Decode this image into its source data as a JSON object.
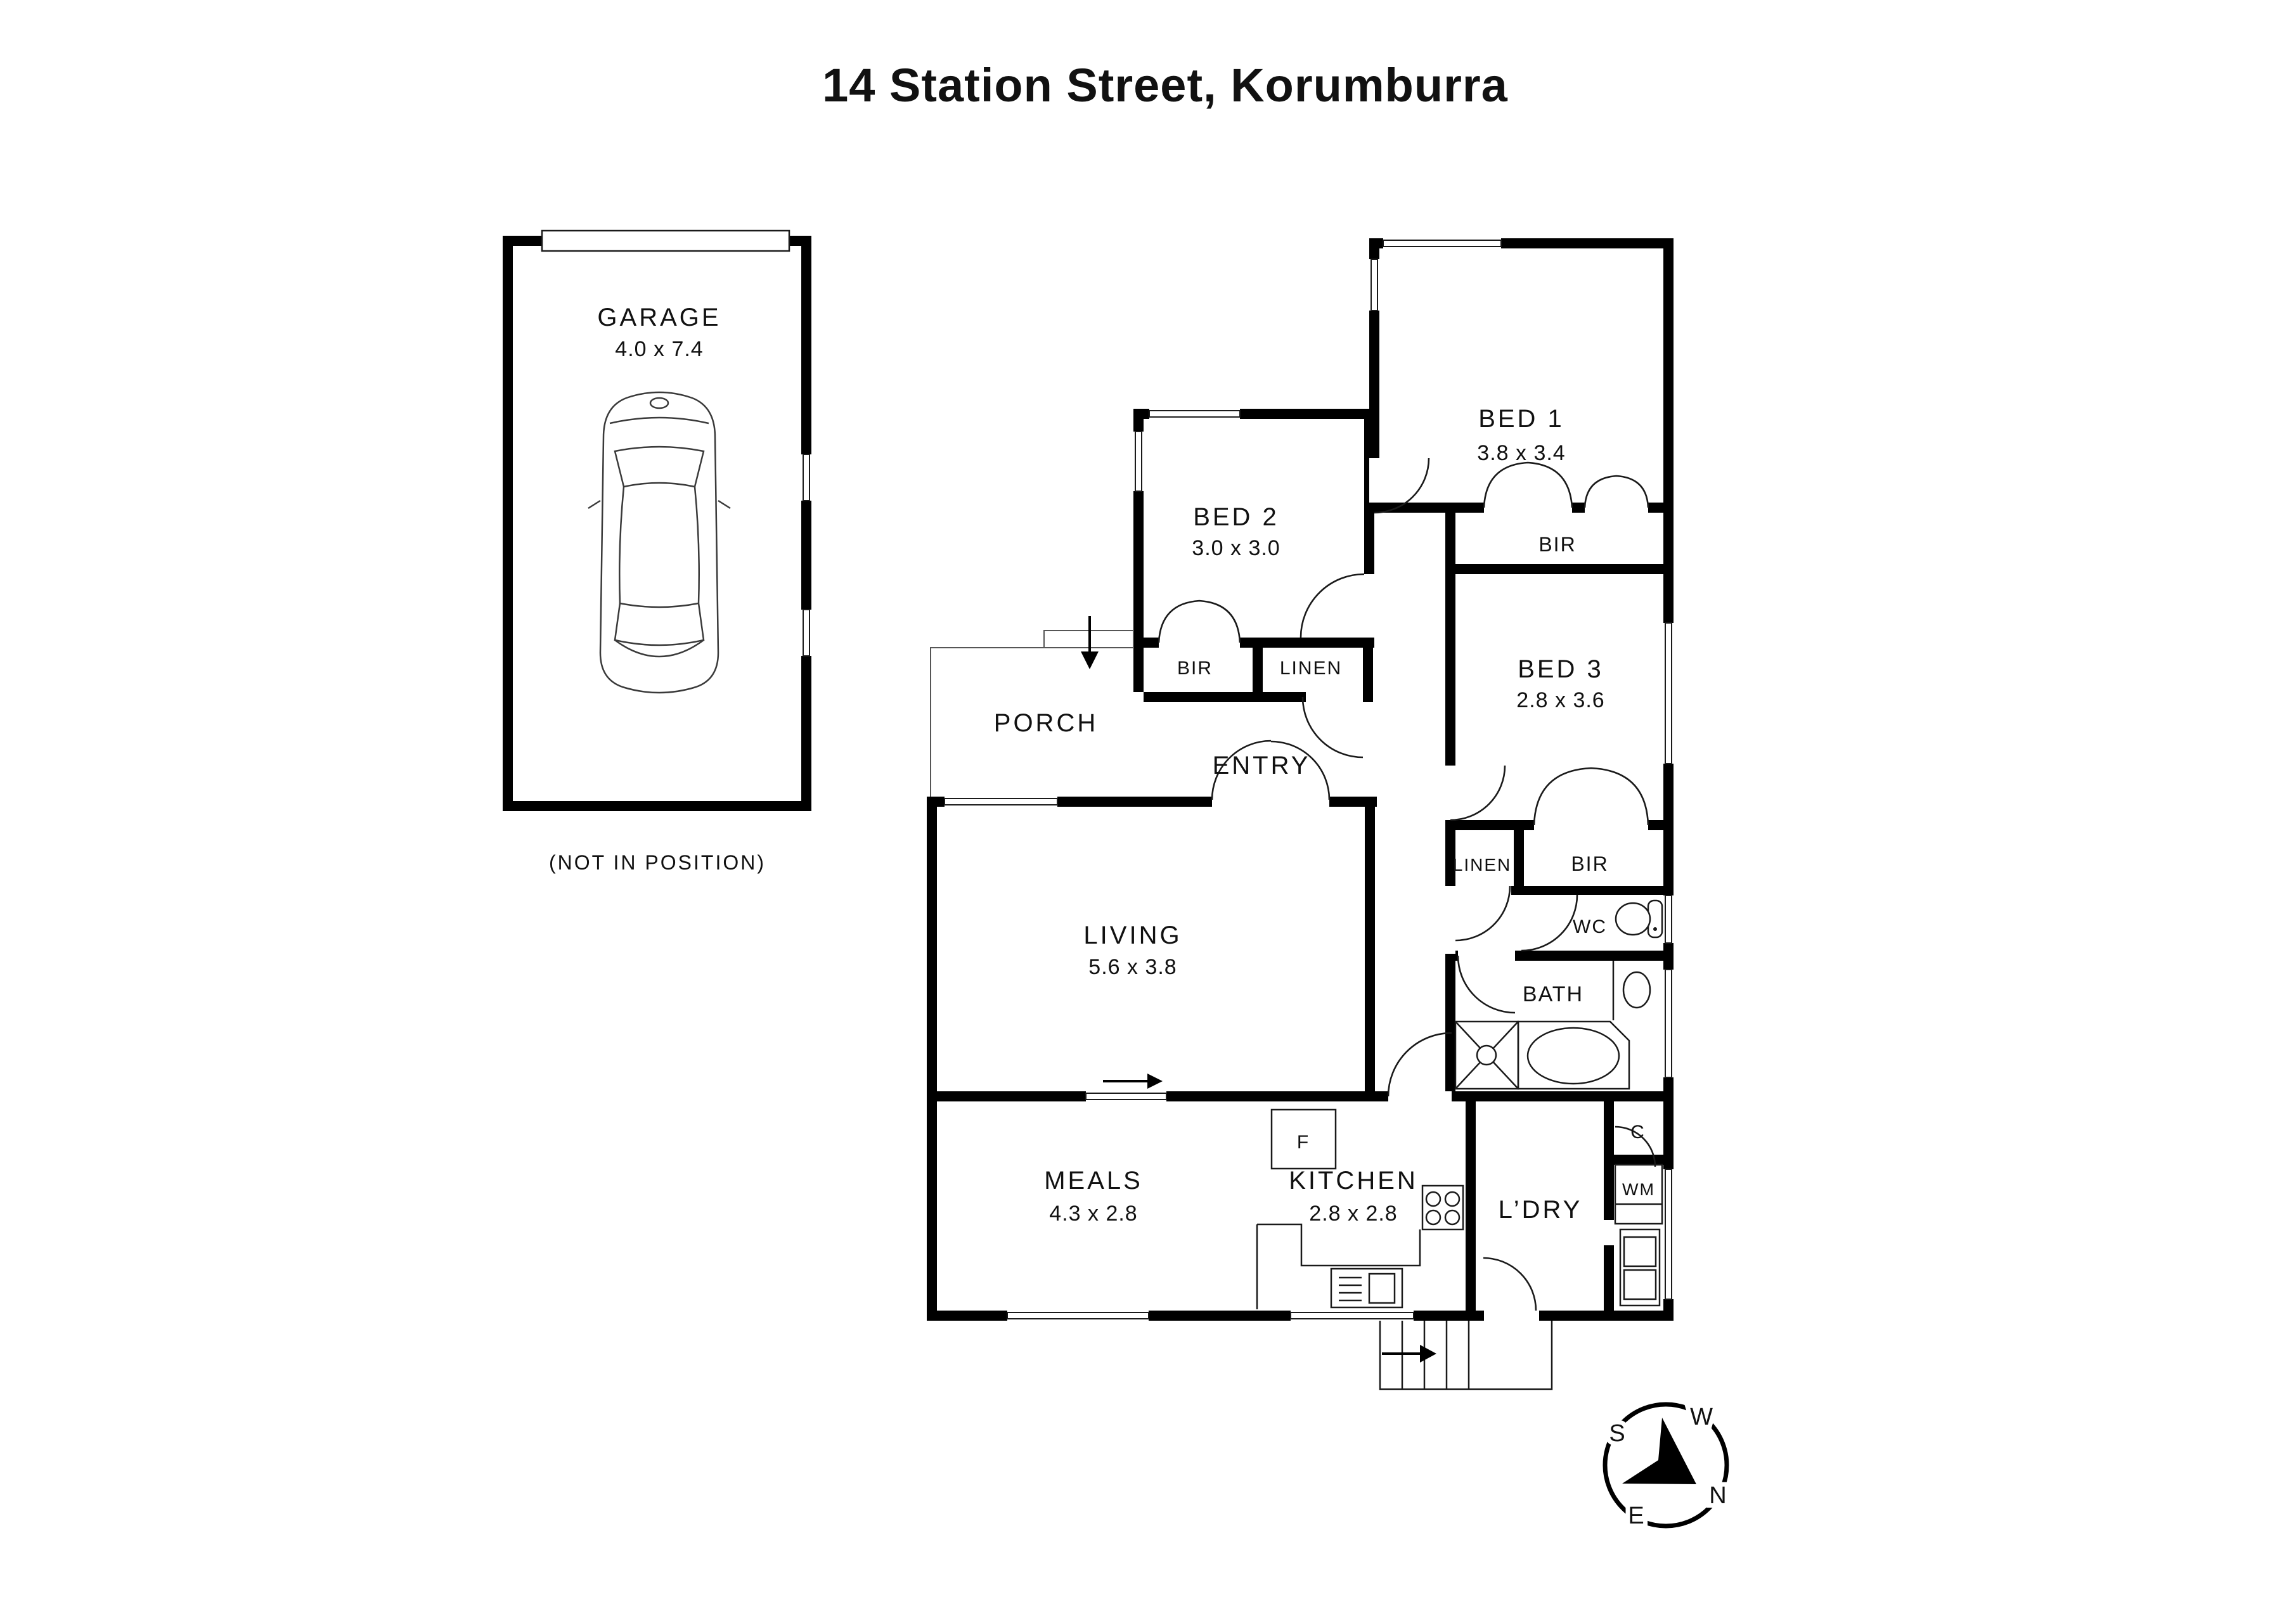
{
  "page": {
    "title": "14 Station Street, Korumburra"
  },
  "garage": {
    "label": "GARAGE",
    "dims": "4.0 x 7.4",
    "note": "(NOT IN POSITION)"
  },
  "rooms": {
    "bed1": {
      "label": "BED 1",
      "dims": "3.8 x 3.4"
    },
    "bed2": {
      "label": "BED 2",
      "dims": "3.0 x 3.0"
    },
    "bed3": {
      "label": "BED 3",
      "dims": "2.8 x 3.6"
    },
    "living": {
      "label": "LIVING",
      "dims": "5.6 x 3.8"
    },
    "meals": {
      "label": "MEALS",
      "dims": "4.3 x 2.8"
    },
    "kitchen": {
      "label": "KITCHEN",
      "dims": "2.8 x 2.8"
    },
    "porch": {
      "label": "PORCH"
    },
    "entry": {
      "label": "ENTRY"
    },
    "laundry": {
      "label": "L’DRY"
    },
    "bath": {
      "label": "BATH"
    },
    "wc": {
      "label": "WC"
    }
  },
  "closets": {
    "bir_bed1": {
      "label": "BIR"
    },
    "bir_bed2": {
      "label": "BIR"
    },
    "bir_bed3": {
      "label": "BIR"
    },
    "linen_entry": {
      "label": "LINEN"
    },
    "linen_hall": {
      "label": "LINEN"
    }
  },
  "fixtures": {
    "fridge": {
      "label": "F"
    },
    "cupboard": {
      "label": "C"
    },
    "washing_machine": {
      "label": "WM"
    }
  },
  "compass": {
    "north": "N",
    "south": "S",
    "east": "E",
    "west": "W"
  },
  "colors": {
    "wall": "#000000",
    "background": "#ffffff",
    "line": "#1a1a1a"
  }
}
